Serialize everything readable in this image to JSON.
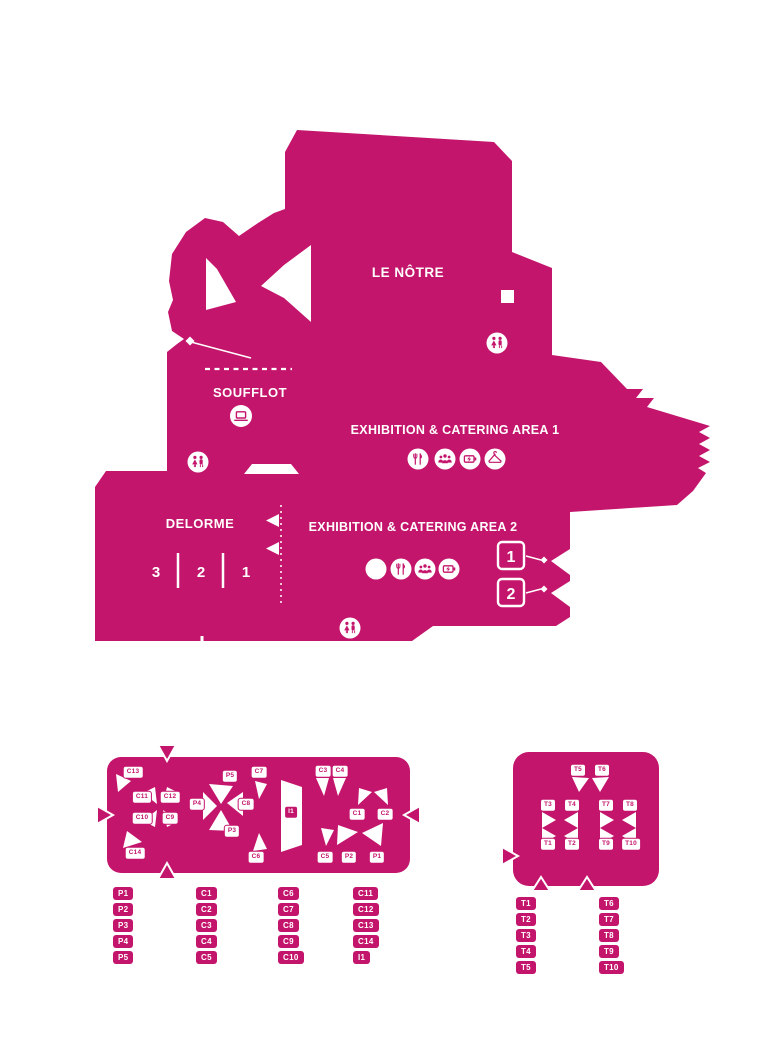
{
  "map": {
    "title_lenotre": "LE NÔTRE",
    "title_soufflot": "SOUFFLOT",
    "title_delorme": "DELORME",
    "area1_label": "EXHIBITION & CATERING AREA 1",
    "area2_label": "EXHIBITION & CATERING AREA 2",
    "delorme_sections": [
      "3",
      "2",
      "1"
    ],
    "doors": [
      "1",
      "2"
    ],
    "icons": {
      "area1": [
        "restaurant-icon",
        "meeting-group-icon",
        "charging-icon",
        "cloakroom-icon"
      ],
      "area2": [
        "hashtag-icon",
        "restaurant-icon",
        "meeting-group-icon",
        "charging-icon"
      ],
      "facilities": [
        "wc-icon",
        "screen-icon",
        "wc-icon",
        "wc-icon"
      ]
    },
    "colors": {
      "primary": "#c4156c",
      "white": "#ffffff"
    }
  },
  "hall_left": {
    "spots": [
      "C13",
      "C11",
      "C12",
      "C10",
      "C9",
      "C14",
      "P5",
      "P4",
      "C8",
      "P3",
      "C7",
      "C6",
      "I1",
      "C3",
      "C4",
      "C1",
      "C2",
      "C5",
      "P2",
      "P1"
    ]
  },
  "hall_right": {
    "spots": [
      "T5",
      "T6",
      "T3",
      "T4",
      "T7",
      "T8",
      "T1",
      "T2",
      "T9",
      "T10"
    ]
  },
  "legend_left": {
    "columns": [
      [
        "P1",
        "P2",
        "P3",
        "P4",
        "P5"
      ],
      [
        "C1",
        "C2",
        "C3",
        "C4",
        "C5"
      ],
      [
        "C6",
        "C7",
        "C8",
        "C9",
        "C10"
      ],
      [
        "C11",
        "C12",
        "C13",
        "C14",
        "I1"
      ]
    ]
  },
  "legend_right": {
    "columns": [
      [
        "T1",
        "T2",
        "T3",
        "T4",
        "T5"
      ],
      [
        "T6",
        "T7",
        "T8",
        "T9",
        "T10"
      ]
    ]
  }
}
